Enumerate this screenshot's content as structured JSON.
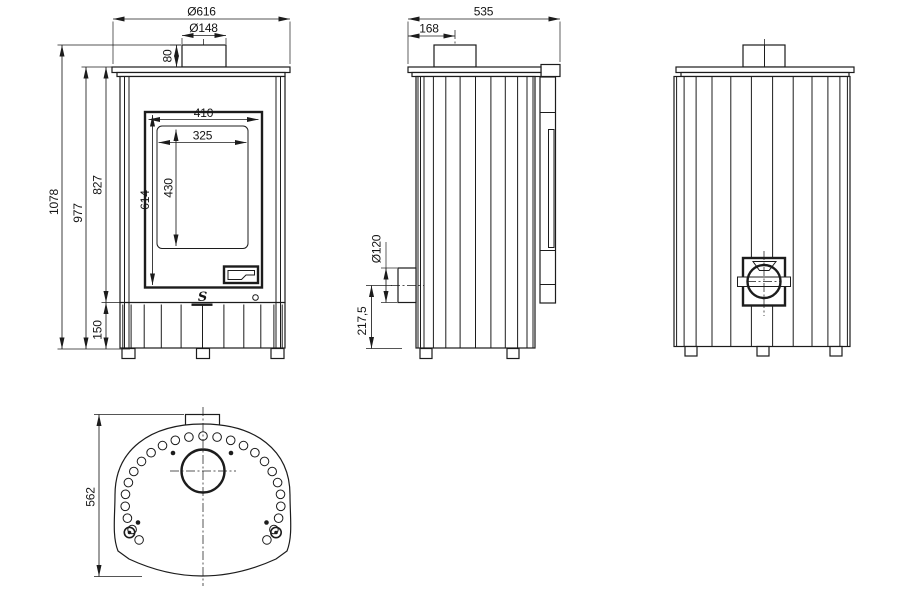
{
  "front_view": {
    "dims": {
      "overall_width": "Ø616",
      "flue_diameter": "Ø148",
      "collar_height": "80",
      "total_height": "1078",
      "body_height": "977",
      "upper_body_height": "827",
      "plinth_height": "150",
      "door_width": "410",
      "glass_width": "325",
      "door_height": "614",
      "glass_height": "430"
    },
    "logo": "S"
  },
  "side_view": {
    "dims": {
      "depth": "535",
      "flue_center_offset": "168",
      "air_inlet_diameter": "Ø120",
      "air_inlet_center_height": "217,5"
    }
  },
  "top_view": {
    "dims": {
      "plate_depth": "562"
    },
    "vent_hole_count": 25
  },
  "colors": {
    "line": "#1c1c1c",
    "background": "#ffffff"
  }
}
